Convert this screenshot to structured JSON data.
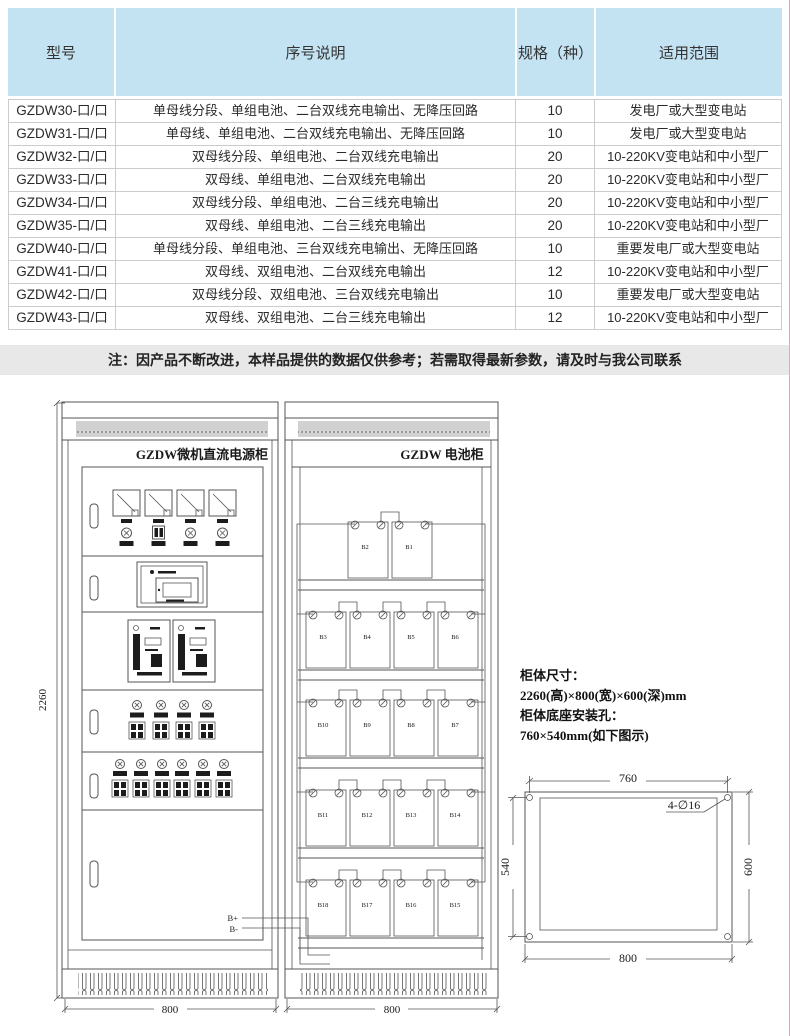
{
  "note": "注：因产品不断改进，本样品提供的数据仅供参考；若需取得最新参数，请及时与我公司联系",
  "table": {
    "headers": [
      "型号",
      "序号说明",
      "规格（种）",
      "适用范围"
    ],
    "rows": [
      [
        "GZDW30-口/口",
        "单母线分段、单组电池、二台双线充电输出、无降压回路",
        "10",
        "发电厂或大型变电站"
      ],
      [
        "GZDW31-口/口",
        "单母线、单组电池、二台双线充电输出、无降压回路",
        "10",
        "发电厂或大型变电站"
      ],
      [
        "GZDW32-口/口",
        "双母线分段、单组电池、二台双线充电输出",
        "20",
        "10-220KV变电站和中小型厂"
      ],
      [
        "GZDW33-口/口",
        "双母线、单组电池、二台双线充电输出",
        "20",
        "10-220KV变电站和中小型厂"
      ],
      [
        "GZDW34-口/口",
        "双母线分段、单组电池、二台三线充电输出",
        "20",
        "10-220KV变电站和中小型厂"
      ],
      [
        "GZDW35-口/口",
        "双母线、单组电池、二台三线充电输出",
        "20",
        "10-220KV变电站和中小型厂"
      ],
      [
        "GZDW40-口/口",
        "单母线分段、单组电池、三台双线充电输出、无降压回路",
        "10",
        "重要发电厂或大型变电站"
      ],
      [
        "GZDW41-口/口",
        "双母线、双组电池、二台双线充电输出",
        "12",
        "10-220KV变电站和中小型厂"
      ],
      [
        "GZDW42-口/口",
        "双母线分段、双组电池、三台双线充电输出",
        "10",
        "重要发电厂或大型变电站"
      ],
      [
        "GZDW43-口/口",
        "双母线、双组电池、二台三线充电输出",
        "12",
        "10-220KV变电站和中小型厂"
      ]
    ]
  },
  "drawing": {
    "power_cabinet": {
      "title": "GZDW微机直流电源柜",
      "width_dim": "800"
    },
    "battery_cabinet": {
      "title": "GZDW 电池柜",
      "width_dim": "800"
    },
    "height_dim": "2260",
    "wire_positive": "B+",
    "wire_negative": "B-",
    "battery_shelves": [
      [
        "B2",
        "B1"
      ],
      [
        "B3",
        "B4",
        "B5",
        "B6"
      ],
      [
        "B10",
        "B9",
        "B8",
        "B7"
      ],
      [
        "B11",
        "B12",
        "B13",
        "B14"
      ],
      [
        "B18",
        "B17",
        "B16",
        "B15"
      ]
    ],
    "specs": [
      "柜体尺寸：",
      "2260(高)×800(宽)×600(深)mm",
      "柜体底座安装孔：",
      "760×540mm(如下图示)"
    ],
    "base_diagram": {
      "top_dim": "760",
      "left_dim": "540",
      "right_dim": "600",
      "bottom_dim": "800",
      "hole_label": "4-∅16"
    }
  },
  "colors": {
    "header_bg": "#c3e2f2",
    "note_bg": "#e8e8e8",
    "line": "#555555",
    "edge_border": "#cfaec2"
  }
}
